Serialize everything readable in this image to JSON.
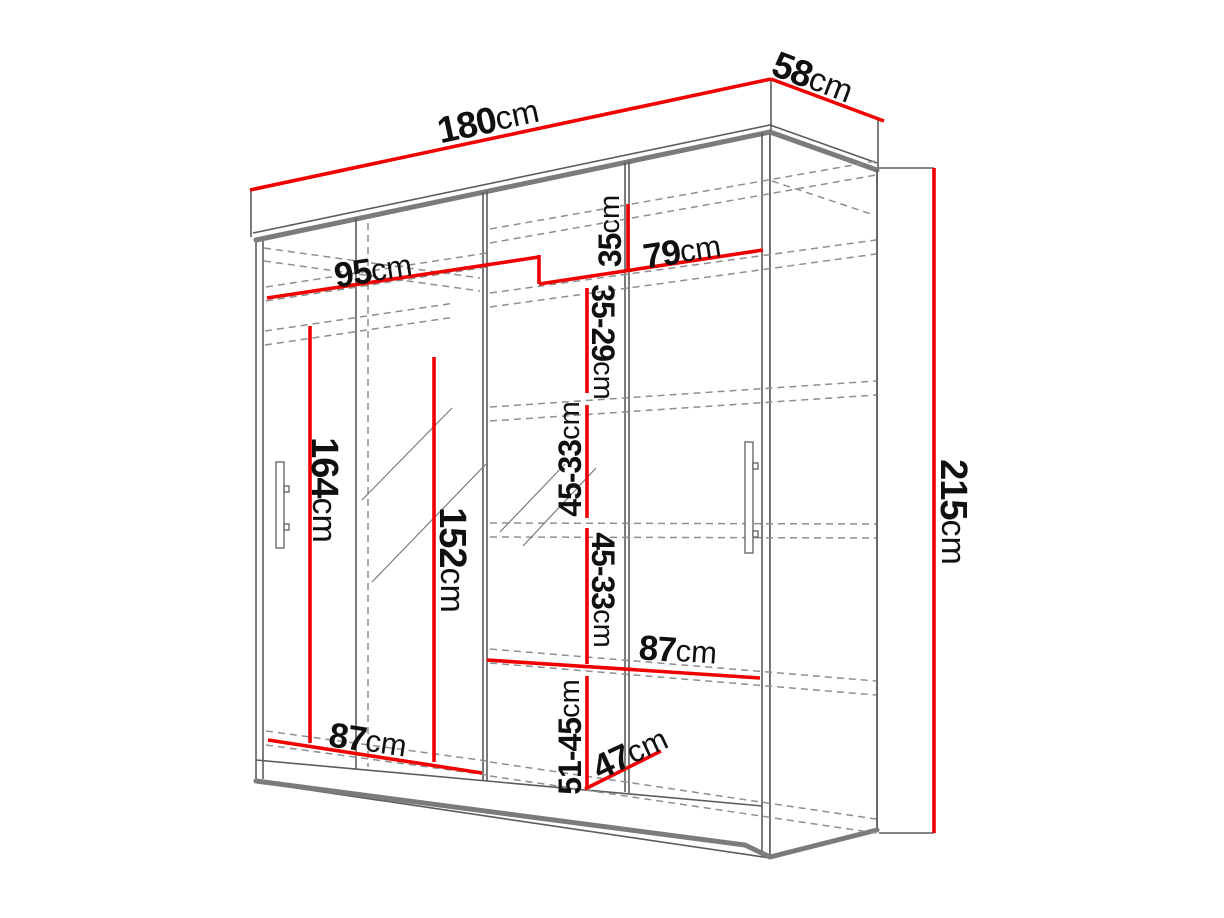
{
  "colors": {
    "dimension_line": "#f10000",
    "outline": "#5c5c5c",
    "text": "#101010",
    "background": "#ffffff"
  },
  "dimensions": {
    "width": {
      "value": "180",
      "unit": "cm"
    },
    "depth": {
      "value": "58",
      "unit": "cm"
    },
    "height": {
      "value": "215",
      "unit": "cm"
    },
    "left_section_width": {
      "value": "95",
      "unit": "cm"
    },
    "right_section_width": {
      "value": "79",
      "unit": "cm"
    },
    "top_shelf_gap": {
      "value": "35",
      "unit": "cm"
    },
    "upper_shelf_gap": {
      "value": "35-29",
      "unit": "cm"
    },
    "middle_shelf_gap_1": {
      "value": "45-33",
      "unit": "cm"
    },
    "middle_shelf_gap_2": {
      "value": "45-33",
      "unit": "cm"
    },
    "lower_shelf_gap": {
      "value": "51-45",
      "unit": "cm"
    },
    "left_hanging_height": {
      "value": "164",
      "unit": "cm"
    },
    "center_hanging_height": {
      "value": "152",
      "unit": "cm"
    },
    "middle_shelf_width": {
      "value": "87",
      "unit": "cm"
    },
    "bottom_shelf_width": {
      "value": "87",
      "unit": "cm"
    },
    "shelf_depth": {
      "value": "47",
      "unit": "cm"
    }
  }
}
